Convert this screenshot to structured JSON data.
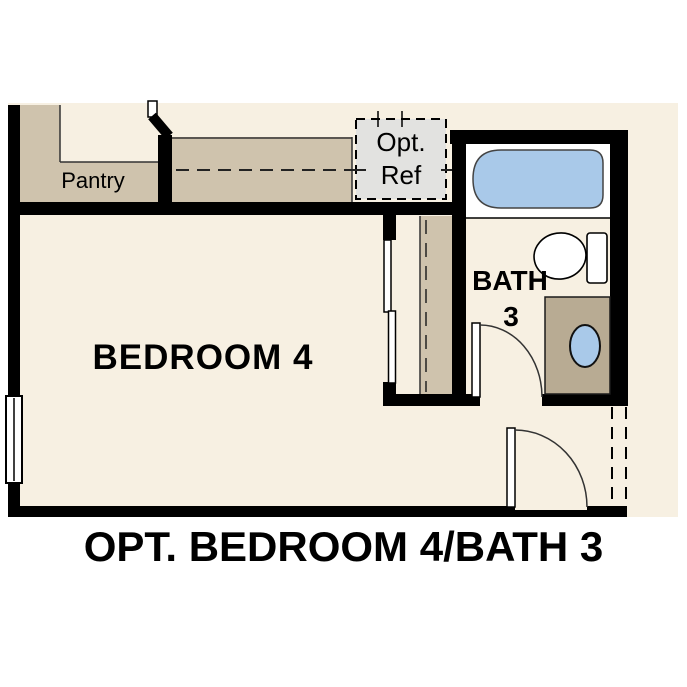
{
  "floorplan": {
    "caption": "OPT. BEDROOM 4/BATH 3",
    "rooms": {
      "pantry": {
        "label": "Pantry"
      },
      "bedroom": {
        "label": "BEDROOM 4"
      },
      "bath": {
        "label_line1": "BATH",
        "label_line2": "3"
      },
      "opt_ref": {
        "label_line1": "Opt.",
        "label_line2": "Ref"
      }
    },
    "colors": {
      "floor_cream": "#f7f0e2",
      "cabinetry_tan": "#cfc3ad",
      "vanity_tan": "#b8ab93",
      "opt_ref_gray": "#e2e2e0",
      "fixture_blue": "#a9c9e9",
      "wall_black": "#000000"
    },
    "fixtures": [
      "bathtub-icon",
      "toilet-icon",
      "sink-icon",
      "window-icon",
      "door-swing-icon",
      "sliding-closet-door-icon",
      "refrigerator-dashed-outline-icon"
    ]
  }
}
